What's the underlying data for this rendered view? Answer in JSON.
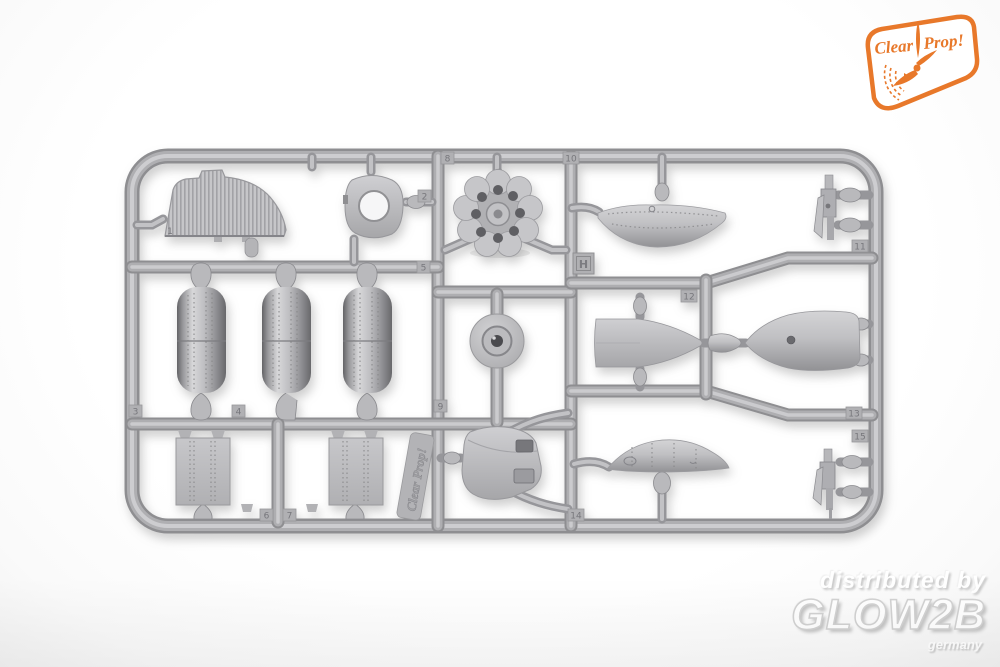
{
  "photo": {
    "background_color": "#fdfdfd",
    "plastic_gray": "#b2b2b5",
    "plastic_dark": "#8e8e91",
    "plastic_light": "#cdcdd0"
  },
  "brand_badge": {
    "word1": "Clear",
    "word2": "Prop!",
    "accent_color": "#e8782a"
  },
  "sprue": {
    "frame_letter": "H",
    "molded_logo_text": "Clear Prop!",
    "part_tags": [
      "1",
      "2",
      "3",
      "4",
      "5",
      "6",
      "7",
      "8",
      "9",
      "10",
      "11",
      "12",
      "13",
      "14",
      "15"
    ]
  },
  "watermark": {
    "line1": "distributed by",
    "line2": "GLOW2B",
    "line3": "germany",
    "text_color": "#ffffff",
    "shadow_color": "#c6c6c6"
  }
}
